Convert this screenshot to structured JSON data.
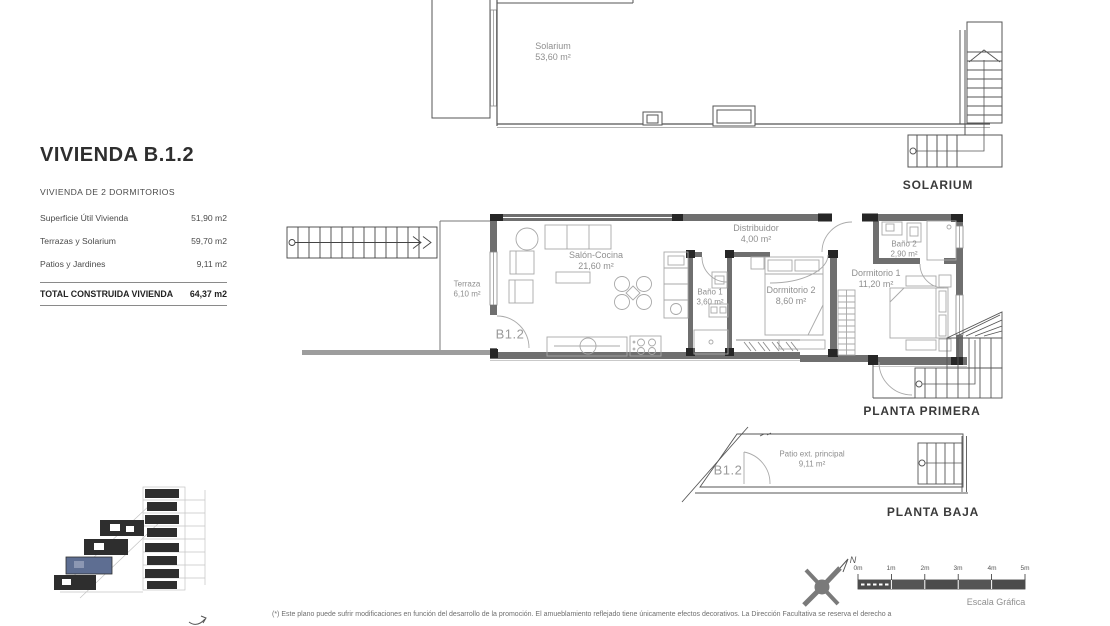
{
  "panel": {
    "title": "VIVIENDA B.1.2",
    "subtitle": "VIVIENDA DE 2 DORMITORIOS",
    "rows": [
      {
        "label": "Superficie Útil Vivienda",
        "value": "51,90 m2"
      },
      {
        "label": "Terrazas y Solarium",
        "value": "59,70 m2"
      },
      {
        "label": "Patios y Jardines",
        "value": "9,11 m2"
      }
    ],
    "total": {
      "label": "TOTAL CONSTRUIDA VIVIENDA",
      "value": "64,37 m2"
    }
  },
  "floors": {
    "solarium": {
      "label": "SOLARIUM",
      "rooms": [
        {
          "name": "Solarium",
          "area": "53,60 m²"
        }
      ]
    },
    "planta_primera": {
      "label": "PLANTA PRIMERA",
      "unit_code": "B1.2",
      "rooms": [
        {
          "name": "Terraza",
          "area": "6,10 m²"
        },
        {
          "name": "Salón-Cocina",
          "area": "21,60 m²"
        },
        {
          "name": "Baño 1",
          "area": "3,60 m²"
        },
        {
          "name": "Distribuidor",
          "area": "4,00 m²"
        },
        {
          "name": "Dormitorio 2",
          "area": "8,60 m²"
        },
        {
          "name": "Dormitorio 1",
          "area": "11,20 m²"
        },
        {
          "name": "Baño 2",
          "area": "2,90 m²"
        }
      ]
    },
    "planta_baja": {
      "label": "PLANTA BAJA",
      "unit_code": "B1.2",
      "rooms": [
        {
          "name": "Patio ext. principal",
          "area": "9,11 m²"
        }
      ]
    }
  },
  "compass": {
    "north_label": "N"
  },
  "scale_bar": {
    "ticks": [
      "0m",
      "1m",
      "2m",
      "3m",
      "4m",
      "5m"
    ],
    "caption": "Escala Gráfica"
  },
  "footnote": "(*) Este plano puede sufrir modificaciones en función del desarrollo de la promoción. El amueblamiento reflejado tiene únicamente efectos decorativos. La Dirección Facultativa se reserva el derecho a",
  "colors": {
    "wall": "#6f6f6f",
    "pillar": "#262626",
    "highlighted_unit": "#5e6e92"
  }
}
